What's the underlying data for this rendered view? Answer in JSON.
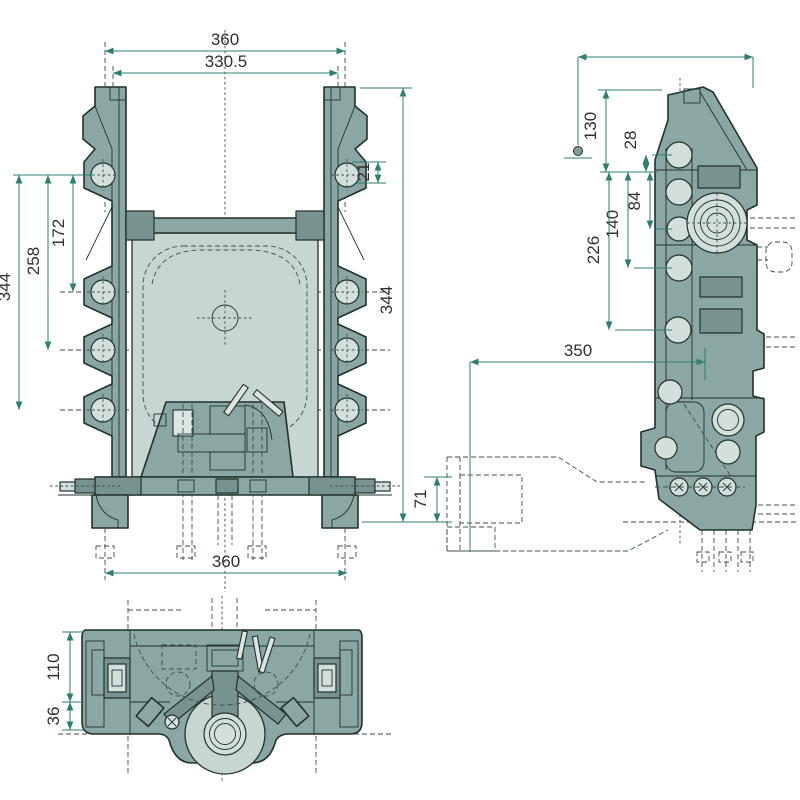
{
  "drawing": {
    "type": "technical-drawing-three-views",
    "views": {
      "front": {
        "label": "front view"
      },
      "side": {
        "label": "side view"
      },
      "bottom": {
        "label": "bottom view"
      }
    },
    "dimensions": {
      "front_top_width": "360",
      "front_top_inner_width": "330.5",
      "front_lug_hole_offset": "21",
      "front_hole_span_small": "172",
      "front_hole_span_mid": "258",
      "front_hole_span_full": "344",
      "front_overall_height": "344",
      "front_base_width": "360",
      "side_upper_height": "130",
      "side_boss_offset": "28",
      "side_boss_span_small": "84",
      "side_boss_span_mid": "140",
      "side_boss_span_large": "226",
      "side_overall_length": "350",
      "side_hitch_height": "71",
      "bottom_depth": "110",
      "bottom_boss_depth": "36"
    },
    "colors": {
      "body": "#8aa7a3",
      "body_dark": "#78938f",
      "panel_light": "#c7d6d2",
      "highlight_light": "#d3dfdb",
      "outline": "#22312f",
      "dashed_line": "#3c4d4b",
      "dimension_line": "#2e7f6e",
      "dimension_text": "#303030",
      "background": "#ffffff"
    }
  }
}
